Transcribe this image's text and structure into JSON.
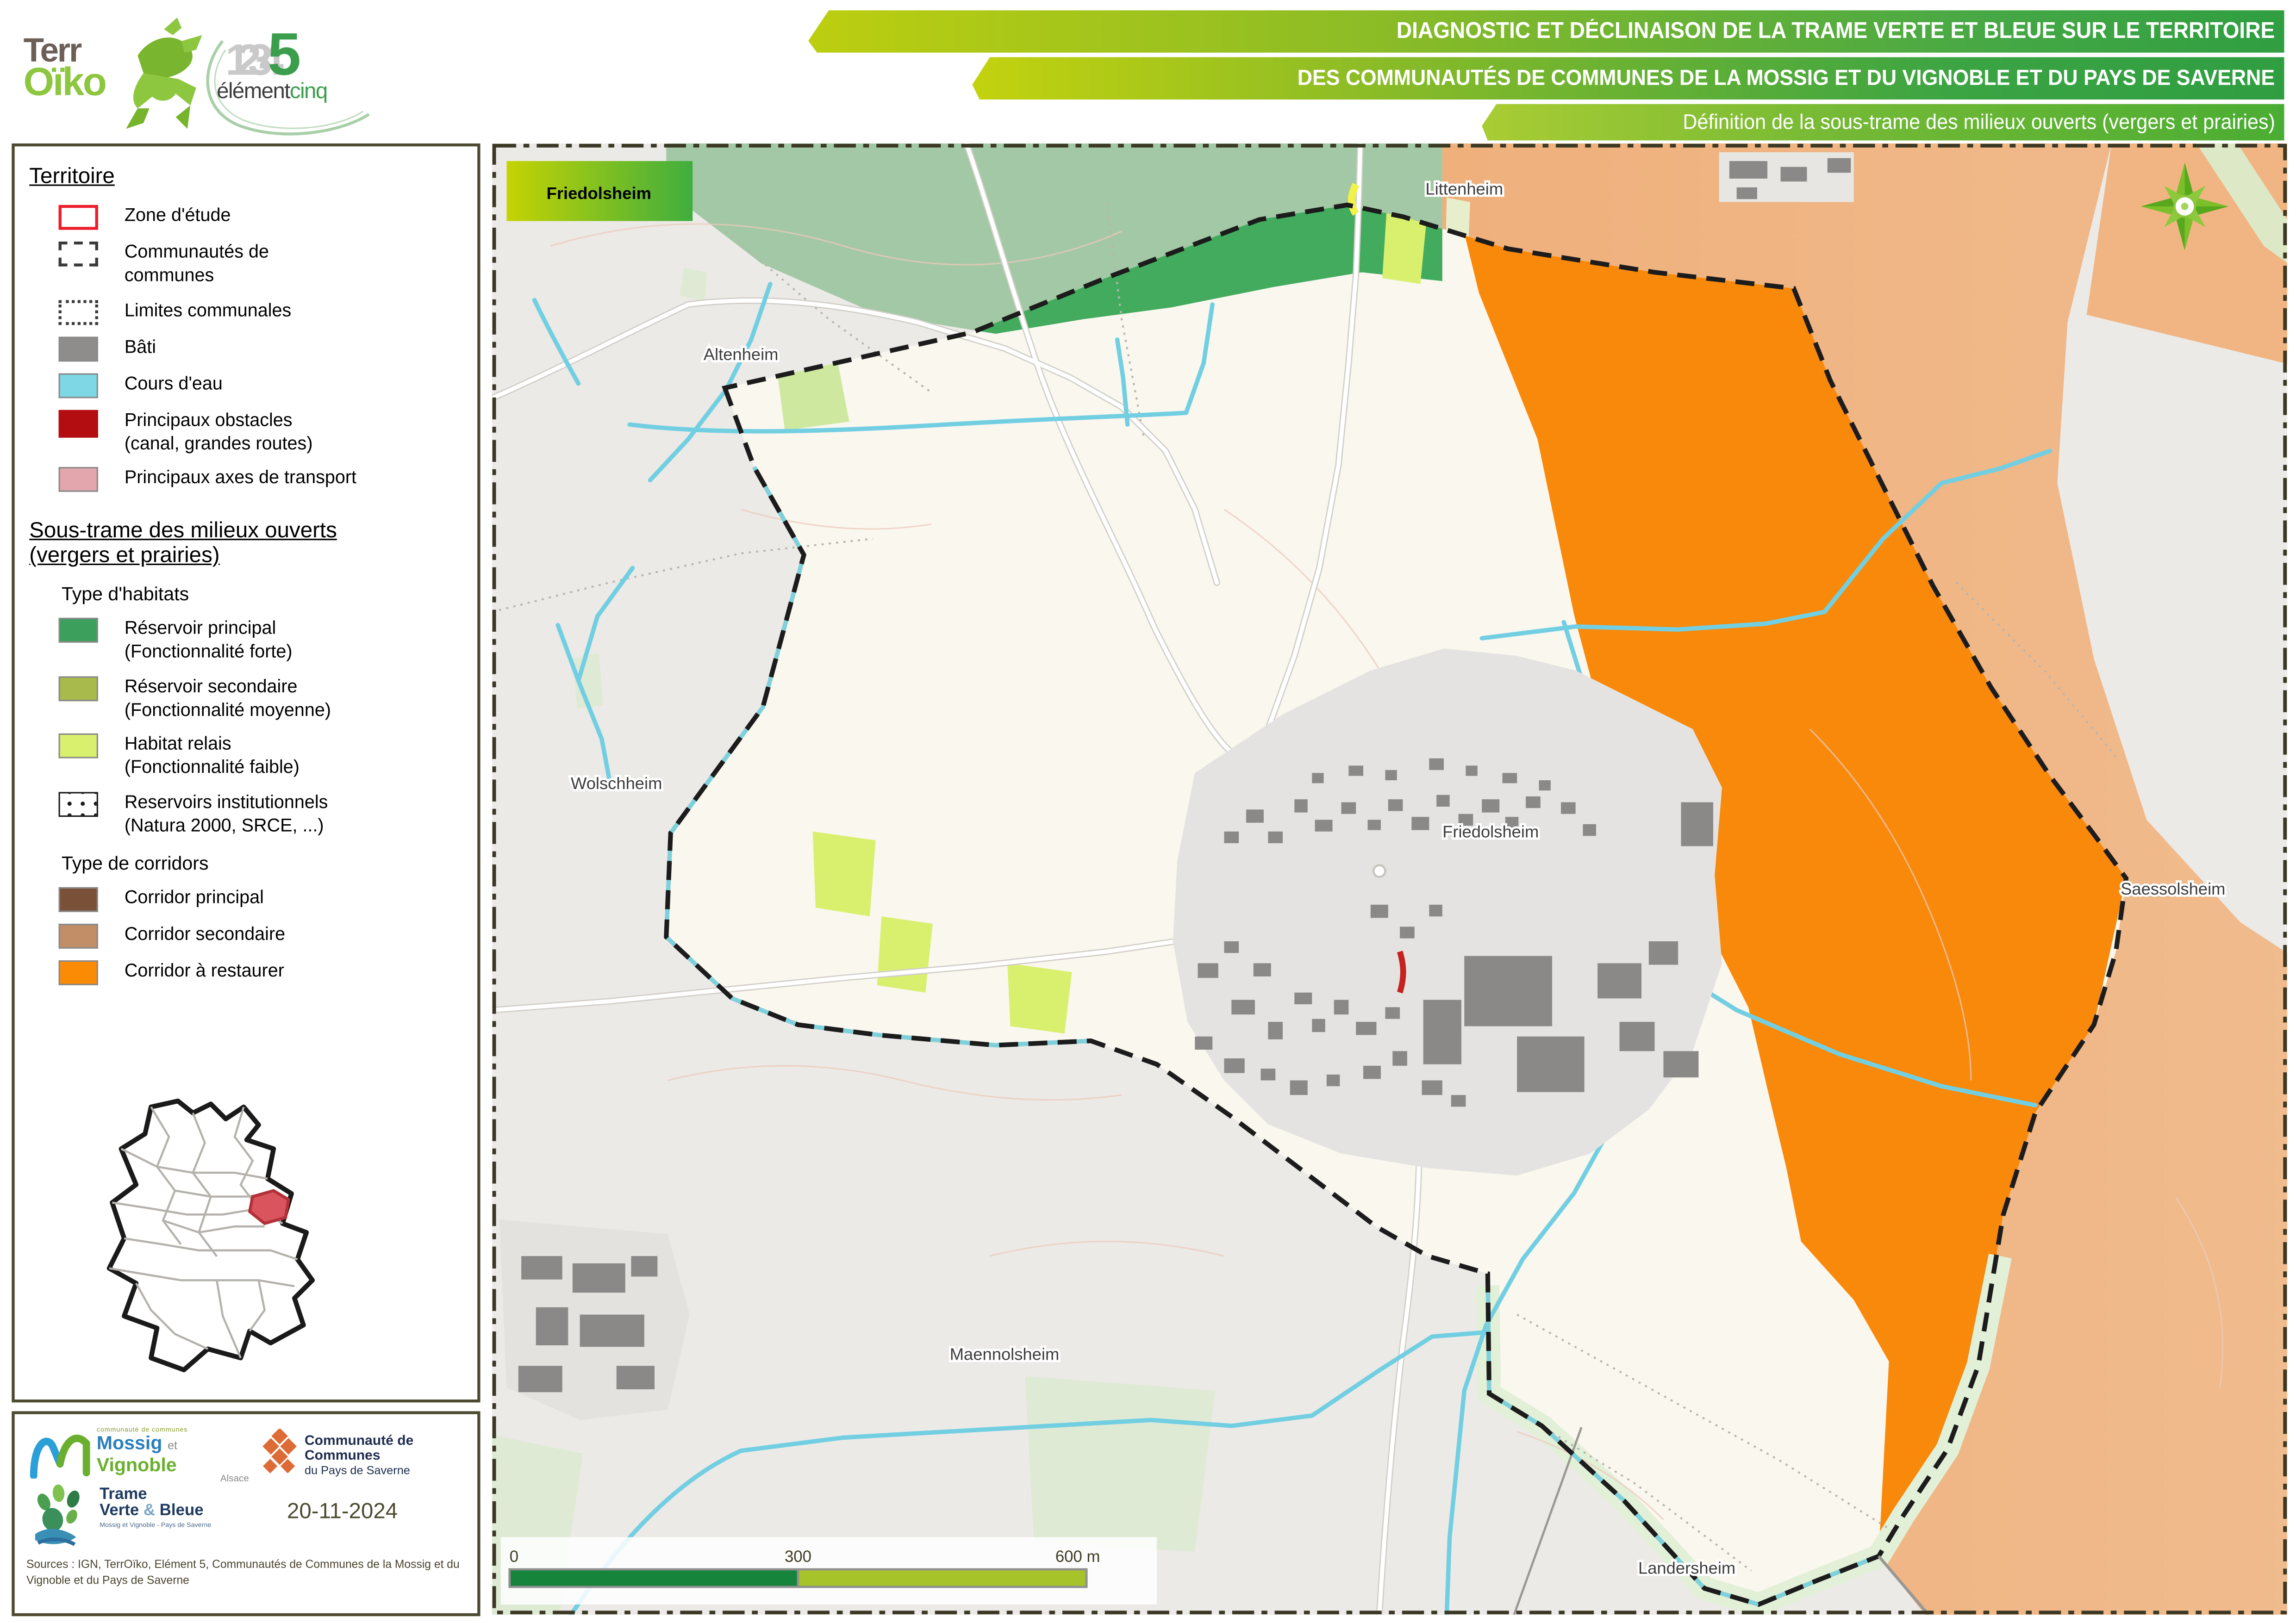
{
  "header": {
    "logo_terroiko": {
      "line1": "Terr",
      "line2": "Oïko"
    },
    "logo_element5": {
      "digits": "1234",
      "five": "5",
      "word1": "élément",
      "word2": "cinq"
    },
    "banners": [
      "DIAGNOSTIC ET DÉCLINAISON DE LA TRAME VERTE ET BLEUE SUR LE TERRITOIRE",
      "DES COMMUNAUTÉS DE COMMUNES DE LA MOSSIG ET DU VIGNOBLE ET DU PAYS DE SAVERNE",
      "Définition de la sous-trame des milieux ouverts (vergers et prairies)"
    ]
  },
  "legend": {
    "territoire": {
      "title": "Territoire",
      "items": [
        {
          "label": "Zone d'étude",
          "color": "#ffffff",
          "border": "#ed1c2a"
        },
        {
          "label": "Communautés de",
          "label2": "communes",
          "style": "dashed"
        },
        {
          "label": "Limites communales",
          "style": "dotted"
        },
        {
          "label": "Bâti",
          "color": "#8f8c8c"
        },
        {
          "label": "Cours d'eau",
          "color": "#7ed7e5"
        },
        {
          "label": "Principaux obstacles",
          "label2": "(canal, grandes routes)",
          "color": "#b30d12"
        },
        {
          "label": "Principaux axes de transport",
          "color": "#e3a6ad"
        }
      ]
    },
    "sous_trame": {
      "title_line1": "Sous-trame des milieux ouverts",
      "title_line2": "(vergers et prairies)",
      "habitats_title": "Type d'habitats",
      "habitats": [
        {
          "label": "Réservoir principal",
          "label2": "(Fonctionnalité forte)",
          "color": "#3ca05c"
        },
        {
          "label": "Réservoir secondaire",
          "label2": "(Fonctionnalité moyenne)",
          "color": "#a9ba4d"
        },
        {
          "label": "Habitat relais",
          "label2": "(Fonctionnalité faible)",
          "color": "#d9f06e"
        },
        {
          "label": "Reservoirs institutionnels",
          "label2": "(Natura 2000, SRCE, ...)",
          "style": "dots"
        }
      ],
      "corridors_title": "Type de corridors",
      "corridors": [
        {
          "label": "Corridor principal",
          "color": "#7a5138"
        },
        {
          "label": "Corridor secondaire",
          "color": "#c28e68"
        },
        {
          "label": "Corridor à restaurer",
          "color": "#fb8a04"
        }
      ]
    }
  },
  "map": {
    "title_box": "Friedolsheim",
    "places": [
      {
        "name": "Altenheim"
      },
      {
        "name": "Littenheim"
      },
      {
        "name": "Wolschheim"
      },
      {
        "name": "Friedolsheim"
      },
      {
        "name": "Saessolsheim"
      },
      {
        "name": "Maennolsheim"
      },
      {
        "name": "Landersheim"
      }
    ],
    "scale_bar": {
      "t0": "0",
      "t300": "300",
      "t600": "600 m"
    },
    "colors": {
      "inside_zone": "#faf7ef",
      "outside_zone": "#eceae7",
      "reservoir_principal": "#43ab5e",
      "reservoir_muted": "#a3c8a5",
      "corridor_restaurer": "#f8890a",
      "corridor_secondaire_pale": "#f0b583",
      "habitat_relais": "#d9f06e",
      "stream": "#72cfe2",
      "bati": "#8b8987",
      "obstacle": "#b30d12"
    }
  },
  "footer": {
    "mossig": {
      "top": "communauté de communes",
      "name1": "Mossig",
      "et": "et",
      "name2": "Vignoble",
      "region": "Alsace"
    },
    "saverne": {
      "line1": "Communauté de Communes",
      "line2": "du Pays de Saverne"
    },
    "tvb": {
      "line1": "Trame",
      "line2a": "Verte",
      "amp": "&",
      "line2b": "Bleue",
      "sub": "Mossig et Vignoble - Pays de Saverne"
    },
    "date": "20-11-2024",
    "sources": "Sources : IGN, TerrOïko, Elément 5, Communautés de Communes de la Mossig et du Vignoble et du Pays de Saverne"
  }
}
